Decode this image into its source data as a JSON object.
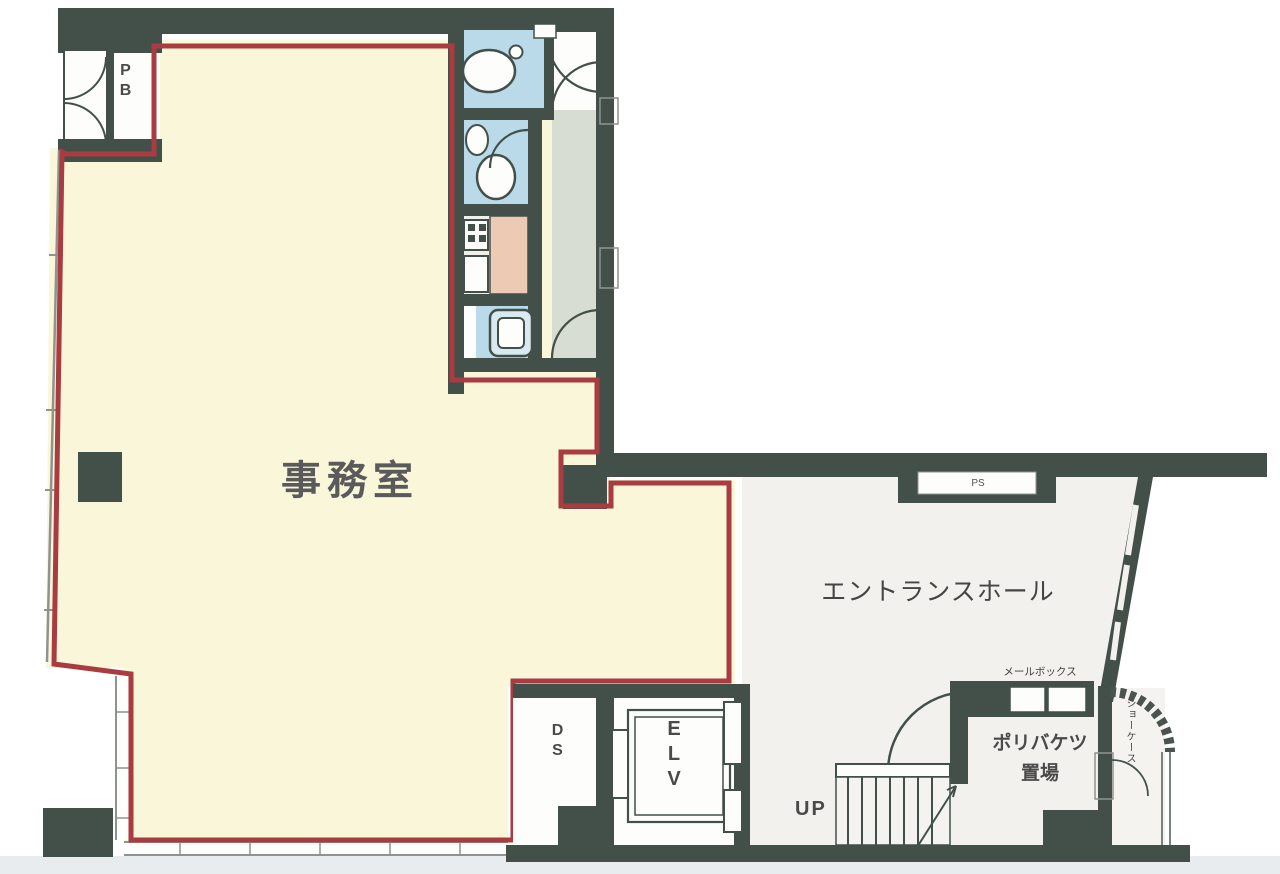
{
  "floorplan": {
    "rooms": {
      "office": {
        "label": "事務室"
      },
      "entrance_hall": {
        "label": "エントランスホール"
      },
      "pipe_box": {
        "label": "PB"
      },
      "pipe_shaft": {
        "label": "PS"
      },
      "duct_space": {
        "label": "DS"
      },
      "elevator": {
        "label": "ELV"
      },
      "stairs": {
        "label": "UP"
      },
      "mailbox": {
        "label": "メールボックス"
      },
      "bucket_storage": {
        "line1": "ポリバケツ",
        "line2": "置場"
      },
      "showcase": {
        "label": "ショーケース"
      }
    },
    "colors": {
      "wall": "#43504a",
      "boundary_red": "#a83c40",
      "office_floor": "#faf6da",
      "wet_area_blue": "#bad9e9",
      "corridor_green": "#d7ddd3",
      "counter_pink": "#eccab4",
      "hall_floor": "#f2f1ed",
      "fixture_white": "#fdfdfc",
      "outside_white": "#ffffff",
      "scan_edge_gray": "#e9ecef"
    }
  }
}
